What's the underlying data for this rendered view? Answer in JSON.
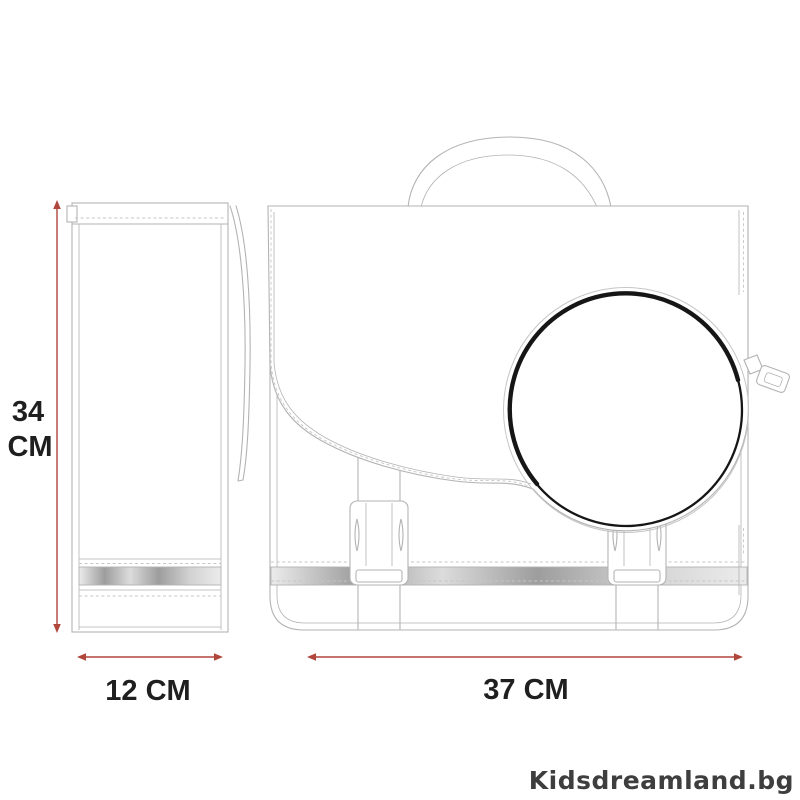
{
  "title": "School bag dimensions technical drawing",
  "colors": {
    "dimension_red": "#b0463c",
    "line_gray": "#b3b3b3",
    "stitch_gray": "#c6c6c6",
    "line_dark": "#161616",
    "text_black": "#1f1f1f",
    "watermark_gray": "#3e3e3e",
    "strip_light": "#ececec",
    "strip_dark": "#9d9d9d"
  },
  "dimensions": {
    "height": {
      "value": "34",
      "unit": "CM"
    },
    "depth": {
      "label": "12 CM"
    },
    "width": {
      "label": "37 CM"
    }
  },
  "watermark": {
    "label": "Kidsdreamland.bg"
  }
}
